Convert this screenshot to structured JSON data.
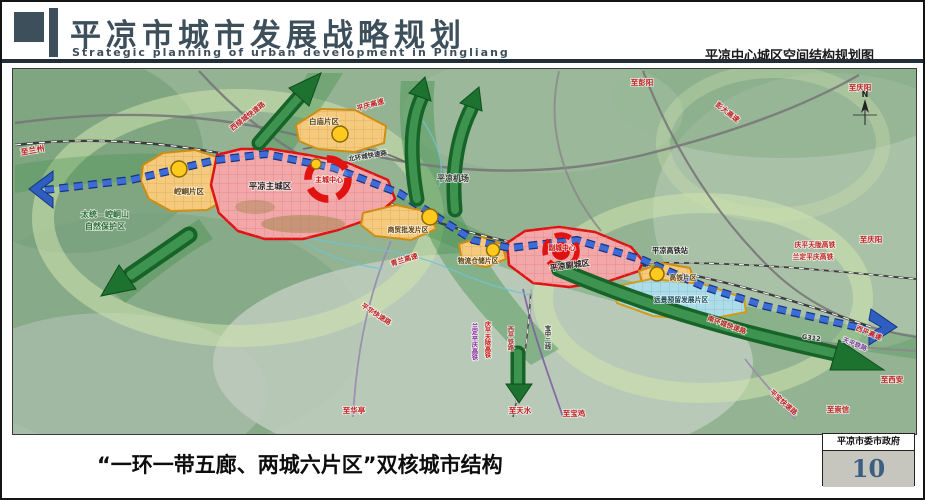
{
  "header": {
    "title": "平凉市城市发展战略规划",
    "subtitle": "Strategic planning of urban development in Pingliang",
    "right_caption": "平凉中心城区空间结构规划图"
  },
  "footer": {
    "caption": "“一环一带五廊、两城六片区”双核城市结构",
    "org": "平凉市委市政府",
    "page_number": "10"
  },
  "map": {
    "compass": "N",
    "legend_colors": {
      "city_fill": "#f2a8a8",
      "city_border": "#e01212",
      "district_fill": "#f6ca7d",
      "district_border": "#d08c10",
      "reserved_fill": "#abdce8",
      "belt_blue": "#3e6cd6",
      "corridor_green": "#1d7230",
      "node_yellow": "#ffc91e"
    },
    "labels": [
      {
        "text": "至兰州"
      },
      {
        "text": "太统—崆峒山"
      },
      {
        "text": "自然保护区"
      },
      {
        "text": "崆峒片区"
      },
      {
        "text": "平凉主城区"
      },
      {
        "text": "主城中心"
      },
      {
        "text": "白庙片区"
      },
      {
        "text": "西绕城快速路"
      },
      {
        "text": "平庆高速"
      },
      {
        "text": "北环城快速路"
      },
      {
        "text": "平凉机场"
      },
      {
        "text": "至彭阳"
      },
      {
        "text": "彭大高速"
      },
      {
        "text": "至庆阳"
      },
      {
        "text": "商贸批发片区"
      },
      {
        "text": "青兰高速"
      },
      {
        "text": "物流仓储片区"
      },
      {
        "text": "平凉副城区"
      },
      {
        "text": "副城中心"
      },
      {
        "text": "平凉高铁站"
      },
      {
        "text": "庆平天陇高铁"
      },
      {
        "text": "兰定平庆高铁"
      },
      {
        "text": "至庆阳"
      },
      {
        "text": "高铁片区"
      },
      {
        "text": "远景预留发展片区"
      },
      {
        "text": "南环城快速路"
      },
      {
        "text": "G312"
      },
      {
        "text": "西平高速"
      },
      {
        "text": "天平铁路"
      },
      {
        "text": "至西安"
      },
      {
        "text": "至崇信"
      },
      {
        "text": "平宝快速路"
      },
      {
        "text": "平华快速路"
      },
      {
        "text": "至华亭"
      },
      {
        "text": "兰定平庆高铁"
      },
      {
        "text": "庆平天陇高铁"
      },
      {
        "text": "西平铁路"
      },
      {
        "text": "宝中二线"
      },
      {
        "text": "至天水"
      },
      {
        "text": "至宝鸡"
      }
    ]
  }
}
